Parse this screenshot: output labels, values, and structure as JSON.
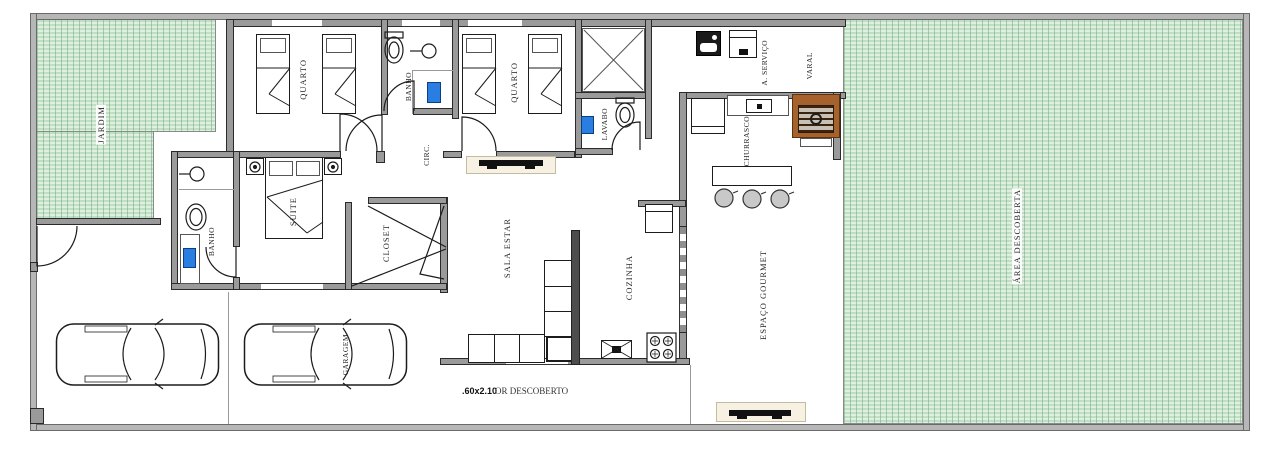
{
  "plan": {
    "rooms": {
      "jardim": "JARDIM",
      "quarto_1": "QUARTO",
      "banho_1": "BANHO",
      "quarto_2": "QUARTO",
      "lavabo": "LAVABO",
      "circ": "CIRC.",
      "suite": "SUITE",
      "banho_suite": "BANHO",
      "closet": "CLOSET",
      "sala_estar": "SALA ESTAR",
      "cozinha": "COZINHA",
      "servico": "A. SERVIÇO",
      "varal": "VARAL",
      "churrasco": "CHURRASCO",
      "espaco_gourmet": "ESPAÇO GOURMET",
      "area_descoberta": "ÁREA DESCOBERTA",
      "garagem": "GARAGEM"
    },
    "annotations": {
      "corridor_dim": ".60x2.10",
      "corridor_text": "OR DESCOBERTO"
    },
    "colors": {
      "grass": "#dff0e0",
      "grass_line": "#6fae7d",
      "wall": "#9a9a9a",
      "grill_brown": "#a5622d",
      "fixture_blue": "#2a7de1"
    }
  }
}
